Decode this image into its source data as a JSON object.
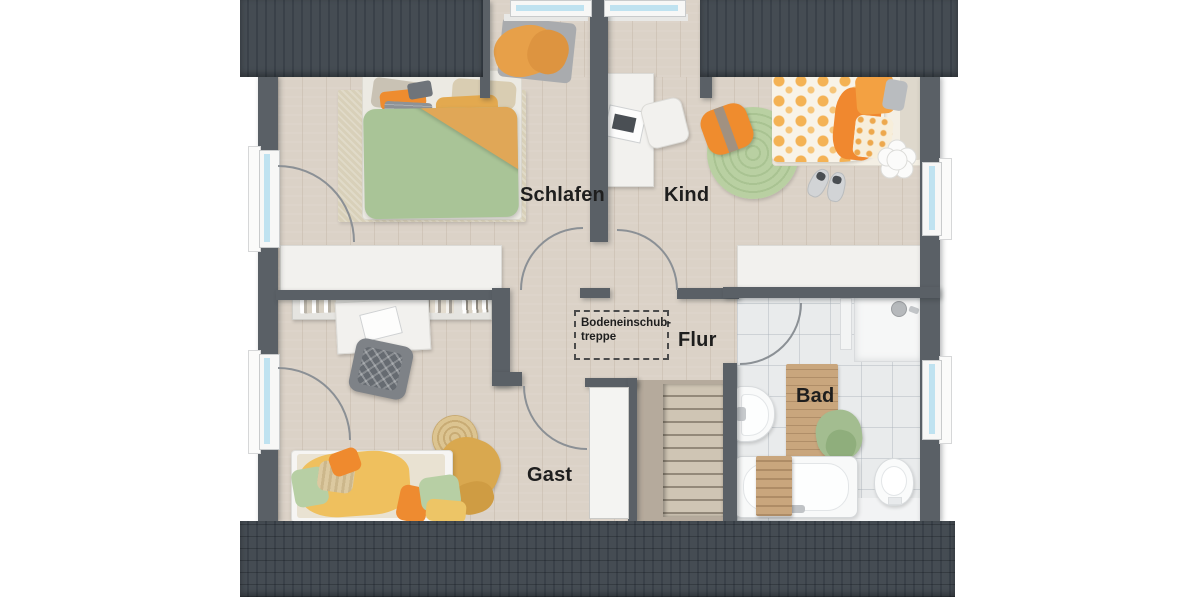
{
  "plan": {
    "rooms": {
      "schlafen": {
        "label": "Schlafen"
      },
      "kind": {
        "label": "Kind"
      },
      "flur": {
        "label": "Flur"
      },
      "gast": {
        "label": "Gast"
      },
      "bad": {
        "label": "Bad"
      }
    },
    "attic_hatch": {
      "line1": "Bodeneinschub-",
      "line2": "treppe"
    },
    "colors": {
      "roof": "#454c53",
      "wall": "#5a6066",
      "wood_floor": "#dbd2c7",
      "tile_floor": "#e9ebec",
      "window_glass": "#bfe2f0",
      "duvet_green": "#a9c497",
      "blanket_orange": "#e0a757",
      "pillow_orange": "#ee8c2f",
      "rug_green": "#b9d0a2",
      "label_text": "#1e1e1e"
    }
  }
}
